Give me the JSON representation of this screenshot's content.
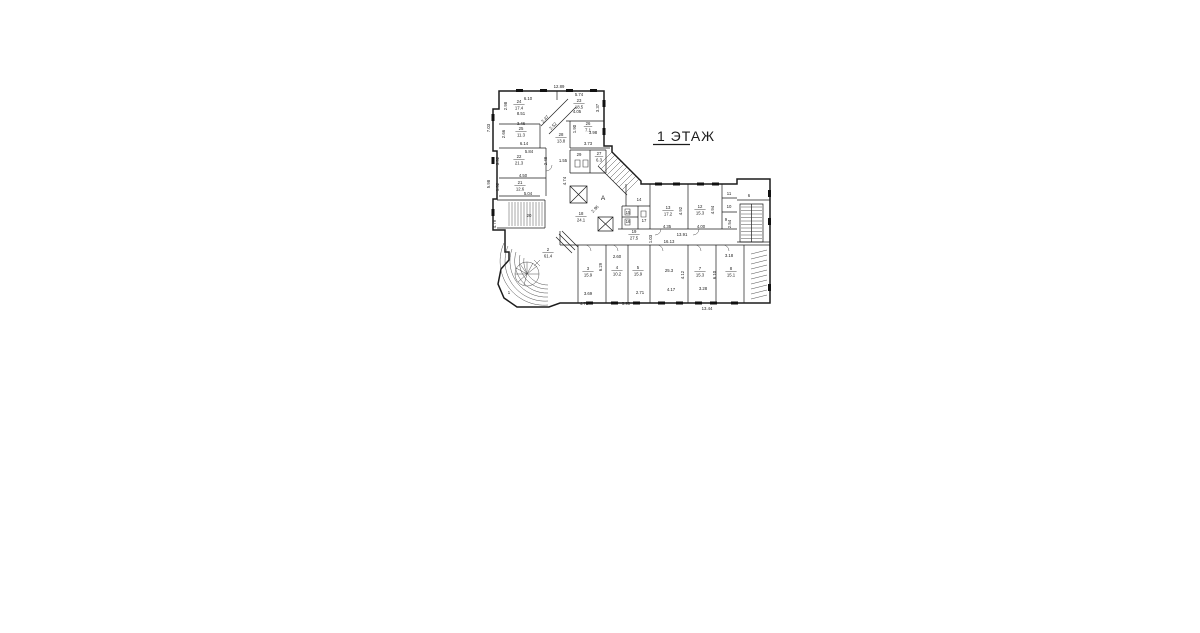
{
  "page": {
    "background": "#ffffff",
    "ink": "#1c1c1c"
  },
  "title": {
    "text": "1  ЭТАЖ"
  },
  "plan": {
    "axis_labels": [
      {
        "t": "A",
        "x": 603,
        "y": 200
      }
    ],
    "rooms": [
      {
        "n": "24",
        "a": "17.4",
        "x": 519,
        "y": 103
      },
      {
        "n": "23",
        "a": "18.5",
        "x": 579,
        "y": 102
      },
      {
        "n": "25",
        "a": "11.3",
        "x": 521,
        "y": 130
      },
      {
        "n": "26",
        "a": "7.1",
        "x": 588,
        "y": 125
      },
      {
        "n": "28",
        "a": "13.8",
        "x": 561,
        "y": 136
      },
      {
        "n": "22",
        "a": "21.3",
        "x": 519,
        "y": 158
      },
      {
        "n": "29",
        "a": "",
        "x": 579,
        "y": 154
      },
      {
        "n": "27",
        "a": "6.3",
        "x": 599,
        "y": 155
      },
      {
        "n": "21",
        "a": "12.6",
        "x": 520,
        "y": 184
      },
      {
        "n": "20",
        "a": "",
        "x": 529,
        "y": 215
      },
      {
        "n": "18",
        "a": "24.1",
        "x": 581,
        "y": 215
      },
      {
        "n": "19",
        "a": "27.5",
        "x": 634,
        "y": 233
      },
      {
        "n": "14",
        "a": "",
        "x": 639,
        "y": 199
      },
      {
        "n": "15",
        "a": "",
        "x": 628,
        "y": 212
      },
      {
        "n": "16",
        "a": "",
        "x": 628,
        "y": 221
      },
      {
        "n": "17",
        "a": "",
        "x": 644,
        "y": 220
      },
      {
        "n": "13",
        "a": "17.2",
        "x": 668,
        "y": 209
      },
      {
        "n": "12",
        "a": "15.3",
        "x": 700,
        "y": 208
      },
      {
        "n": "11",
        "a": "",
        "x": 729,
        "y": 193
      },
      {
        "n": "10",
        "a": "",
        "x": 729,
        "y": 206
      },
      {
        "n": "9",
        "a": "",
        "x": 726,
        "y": 219
      },
      {
        "n": "6",
        "a": "",
        "x": 749,
        "y": 195
      },
      {
        "n": "2",
        "a": "61.4",
        "x": 548,
        "y": 251
      },
      {
        "n": "1",
        "a": "",
        "x": 509,
        "y": 292
      },
      {
        "n": "3",
        "a": "15.9",
        "x": 588,
        "y": 270
      },
      {
        "n": "4",
        "a": "10.2",
        "x": 617,
        "y": 269
      },
      {
        "n": "5",
        "a": "15.9",
        "x": 638,
        "y": 269
      },
      {
        "n": "",
        "a": "25.3",
        "x": 669,
        "y": 270
      },
      {
        "n": "7",
        "a": "15.3",
        "x": 700,
        "y": 270
      },
      {
        "n": "8",
        "a": "15.1",
        "x": 731,
        "y": 270
      }
    ],
    "dimensions": [
      {
        "t": "12.89",
        "x": 559,
        "y": 88
      },
      {
        "t": "7.03",
        "x": 490,
        "y": 128,
        "r": -90
      },
      {
        "t": "5.98",
        "x": 490,
        "y": 184,
        "r": -90
      },
      {
        "t": "4.79",
        "x": 496,
        "y": 224,
        "r": -90
      },
      {
        "t": "6.10",
        "x": 528,
        "y": 100
      },
      {
        "t": "8.51",
        "x": 521,
        "y": 115
      },
      {
        "t": "2.98",
        "x": 507,
        "y": 106,
        "r": -90
      },
      {
        "t": "5.74",
        "x": 579,
        "y": 96
      },
      {
        "t": "4.05",
        "x": 577,
        "y": 113
      },
      {
        "t": "3.37",
        "x": 599,
        "y": 108,
        "r": -90
      },
      {
        "t": "3.46",
        "x": 521,
        "y": 125
      },
      {
        "t": "6.14",
        "x": 524,
        "y": 145
      },
      {
        "t": "2.66",
        "x": 505,
        "y": 134,
        "r": -90
      },
      {
        "t": "2.47",
        "x": 546,
        "y": 120,
        "r": -45
      },
      {
        "t": "2.52",
        "x": 554,
        "y": 127,
        "r": -45
      },
      {
        "t": "1.90",
        "x": 576,
        "y": 129,
        "r": -90
      },
      {
        "t": "3.98",
        "x": 593,
        "y": 134
      },
      {
        "t": "3.73",
        "x": 588,
        "y": 145
      },
      {
        "t": "5.84",
        "x": 529,
        "y": 153
      },
      {
        "t": "4.50",
        "x": 523,
        "y": 177
      },
      {
        "t": "3.52",
        "x": 499,
        "y": 161,
        "r": -90
      },
      {
        "t": "2.48",
        "x": 547,
        "y": 161,
        "r": -90
      },
      {
        "t": "1.55",
        "x": 563,
        "y": 162
      },
      {
        "t": "4.74",
        "x": 566,
        "y": 181,
        "r": -90
      },
      {
        "t": "5.04",
        "x": 528,
        "y": 195
      },
      {
        "t": "1.52",
        "x": 499,
        "y": 187,
        "r": -90
      },
      {
        "t": "2.96",
        "x": 596,
        "y": 210,
        "r": -45
      },
      {
        "t": "4.35",
        "x": 667,
        "y": 228
      },
      {
        "t": "4.92",
        "x": 682,
        "y": 211,
        "r": -90
      },
      {
        "t": "4.00",
        "x": 701,
        "y": 228
      },
      {
        "t": "4.94",
        "x": 714,
        "y": 210,
        "r": -90
      },
      {
        "t": "13.91",
        "x": 682,
        "y": 236
      },
      {
        "t": "16.13",
        "x": 669,
        "y": 243
      },
      {
        "t": "1.03",
        "x": 652,
        "y": 239,
        "r": -90
      },
      {
        "t": "2.54",
        "x": 731,
        "y": 224,
        "r": -90
      },
      {
        "t": "2.60",
        "x": 617,
        "y": 258
      },
      {
        "t": "6.29",
        "x": 602,
        "y": 267,
        "r": -90
      },
      {
        "t": "3.69",
        "x": 588,
        "y": 295
      },
      {
        "t": "2.71",
        "x": 640,
        "y": 294
      },
      {
        "t": "4.17",
        "x": 671,
        "y": 291
      },
      {
        "t": "3.28",
        "x": 703,
        "y": 290
      },
      {
        "t": "4.12",
        "x": 684,
        "y": 275,
        "r": -90
      },
      {
        "t": "6.10",
        "x": 716,
        "y": 275,
        "r": -90
      },
      {
        "t": "3.18",
        "x": 729,
        "y": 257
      },
      {
        "t": "4.78",
        "x": 584,
        "y": 305
      },
      {
        "t": "5.90",
        "x": 626,
        "y": 305
      },
      {
        "t": "13.44",
        "x": 707,
        "y": 310
      }
    ]
  }
}
